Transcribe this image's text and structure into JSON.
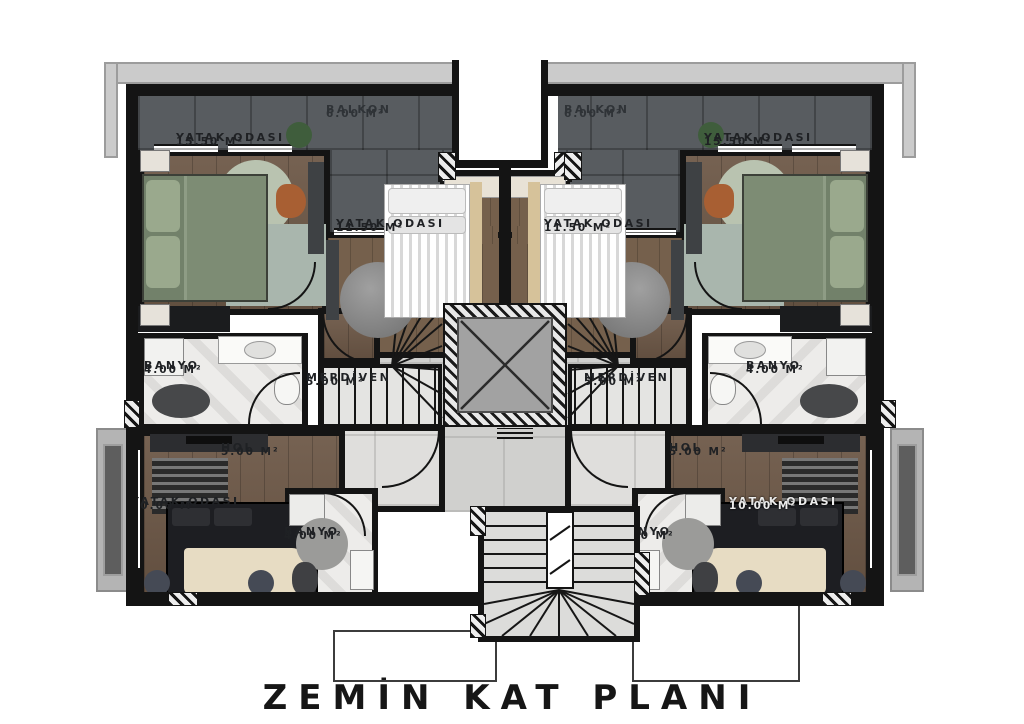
{
  "title": "ZEMİN KAT PLANI",
  "rooms": {
    "balkon": {
      "name": "BALKON",
      "area": "6.00 M²"
    },
    "bedroom15": {
      "name": "YATAK ODASI",
      "area": "15.50 M²"
    },
    "bedroom11": {
      "name": "YATAK ODASI",
      "area": "11.50 M²"
    },
    "banyo_upper": {
      "name": "BANYO",
      "area": "4.00 M²"
    },
    "merdiven": {
      "name": "MERDİVEN",
      "area": "5.00 M²"
    },
    "hol": {
      "name": "HOL",
      "area": "5.00 M²"
    },
    "bedroom10": {
      "name": "YATAK ODASI",
      "area": "10.00 M²"
    },
    "banyo_lower": {
      "name": "BANYO",
      "area": "4.00 M²"
    }
  },
  "colors": {
    "wall": "#141414",
    "balcony_tile": "#585c60",
    "wood_floor": "#6d5847",
    "bath_marble": "#edecea",
    "corridor_tile": "#d0d0ce",
    "elevator_cab": "#a2a2a2",
    "roof_eave": "#cbcbcb"
  }
}
